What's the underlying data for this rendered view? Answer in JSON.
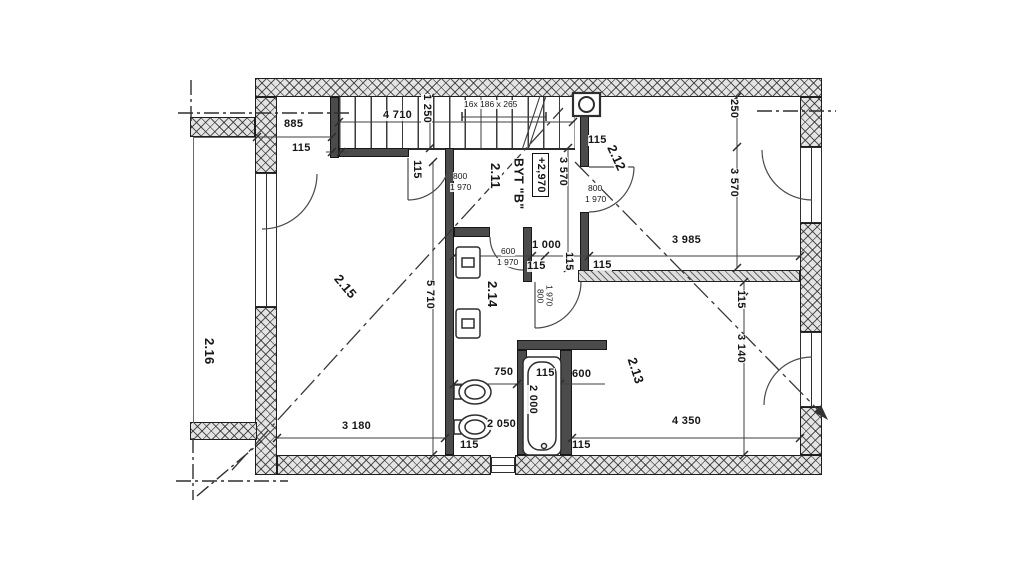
{
  "plan": {
    "apartment_label": "BYT \"B\"",
    "elevation_label": "+2,970",
    "stairs_spec": "16x 186 x 265",
    "rooms": {
      "r211": "2.11",
      "r212": "2.12",
      "r213": "2.13",
      "r214": "2.14",
      "r215": "2.15",
      "r216": "2.16"
    },
    "dims": {
      "d115": "115",
      "d250": "250",
      "d600": "600",
      "d750": "750",
      "d800": "800",
      "d885": "885",
      "d1000": "1 000",
      "d1250": "1 250",
      "d1970": "1 970",
      "d2000": "2 000",
      "d2050": "2 050",
      "d3140": "3 140",
      "d3180": "3 180",
      "d3570": "3 570",
      "d3985": "3 985",
      "d4350": "4 350",
      "d4710": "4 710",
      "d5710": "5 710"
    },
    "colors": {
      "paper": "#ffffff",
      "linework": "#2a2a2a",
      "wall_fill": "#e3e3e3"
    }
  }
}
